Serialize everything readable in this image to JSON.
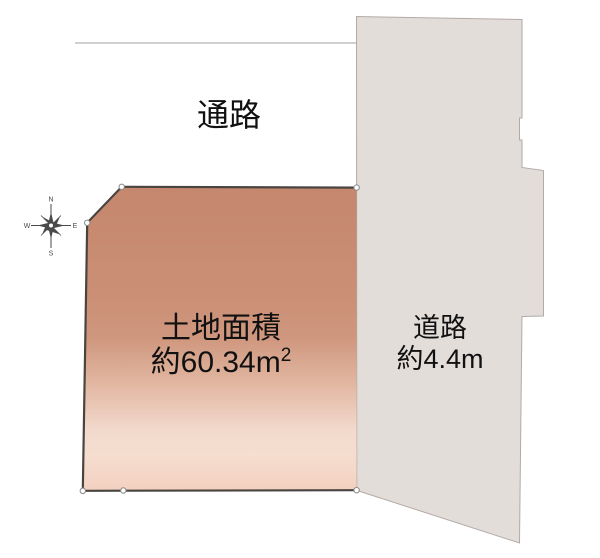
{
  "page": {
    "width": 600,
    "height": 558,
    "background": "#ffffff"
  },
  "labels": {
    "passage": "通路",
    "plot_area_line1": "土地面積",
    "plot_area_line2_value": "約60.34m",
    "plot_area_line2_sup": "2",
    "road_line1": "道路",
    "road_line2": "約4.4m"
  },
  "compass": {
    "n": "N",
    "e": "E",
    "s": "S",
    "w": "W"
  },
  "colors": {
    "plot_gradient_top": "#c5876d",
    "plot_gradient_mid": "#cf977e",
    "plot_gradient_light": "#f5decf",
    "plot_gradient_bottom": "#f3d0c0",
    "plot_border": "#4a4440",
    "road_fill": "#e3ddd9",
    "road_border": "#b2aaa6",
    "passage_line": "#b3b3b3",
    "corner_dot_fill": "#ffffff",
    "corner_dot_stroke": "#8a8a8a",
    "compass_color": "#4a4a4a",
    "text": "#111111"
  }
}
